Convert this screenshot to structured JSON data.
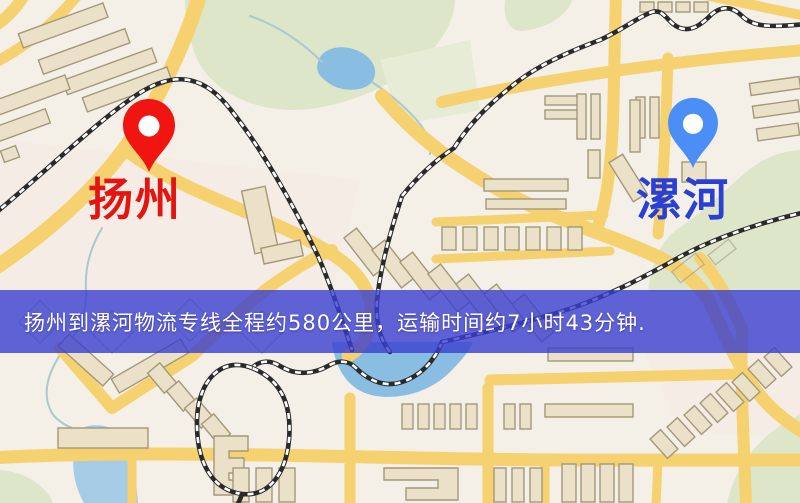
{
  "map": {
    "palette": {
      "background": "#f4efe7",
      "road_yellow": "#f5d170",
      "road_casing": "#e7c05e",
      "building_fill": "#eae1c8",
      "building_stroke": "#a4987a",
      "park_green": "#dde6c8",
      "water_blue": "#8abde2",
      "railway_black": "#2a2a2a"
    }
  },
  "markers": {
    "origin": {
      "label": "扬州",
      "label_color": "#e41410",
      "pin_color": "#f01511",
      "icon": "map-pin-icon"
    },
    "destination": {
      "label": "漯河",
      "label_color": "#2940d2",
      "pin_color": "#4b8ef5",
      "icon": "map-pin-icon"
    }
  },
  "banner": {
    "text": "扬州到漯河物流专线全程约580公里，运输时间约7小时43分钟.",
    "background": "rgba(58,63,208,0.8)",
    "text_color": "#ffffff"
  }
}
